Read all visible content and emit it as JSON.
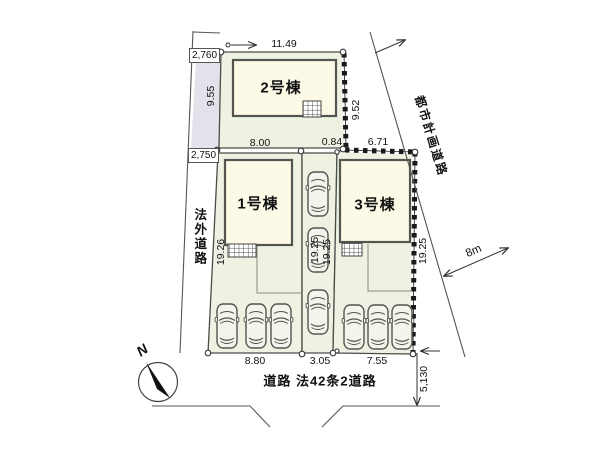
{
  "lots": {
    "lot2": {
      "label": "2号棟",
      "width_top": "11.49",
      "depth_left": "9.55",
      "depth_right": "9.52"
    },
    "lot1": {
      "label": "1号棟",
      "width_top": "8.00",
      "depth_left": "19.26",
      "width_bottom": "8.80"
    },
    "lot3": {
      "label": "3号棟",
      "width_top": "6.71",
      "top_offset": "0.84",
      "depth_right": "19.25",
      "width_bottom": "7.55"
    },
    "driveway": {
      "width_bottom": "3.05",
      "depth_left": "19.25",
      "depth_right": "19.25"
    }
  },
  "roads": {
    "left": {
      "label": "法外道路",
      "width_top": "2,760",
      "width_bottom": "2,750"
    },
    "city_planning": {
      "label": "都市計画道路",
      "width": "8m"
    },
    "south": {
      "label": "道路 法42条2道路",
      "width": "5,130"
    }
  },
  "compass": {
    "north": "N"
  },
  "colors": {
    "lot_fill": "#edf2e2",
    "building_fill": "#fcfae6",
    "road_fill": "#e2e3ea",
    "line": "#4c4c48",
    "tie_mark": "#1a1a1a"
  }
}
